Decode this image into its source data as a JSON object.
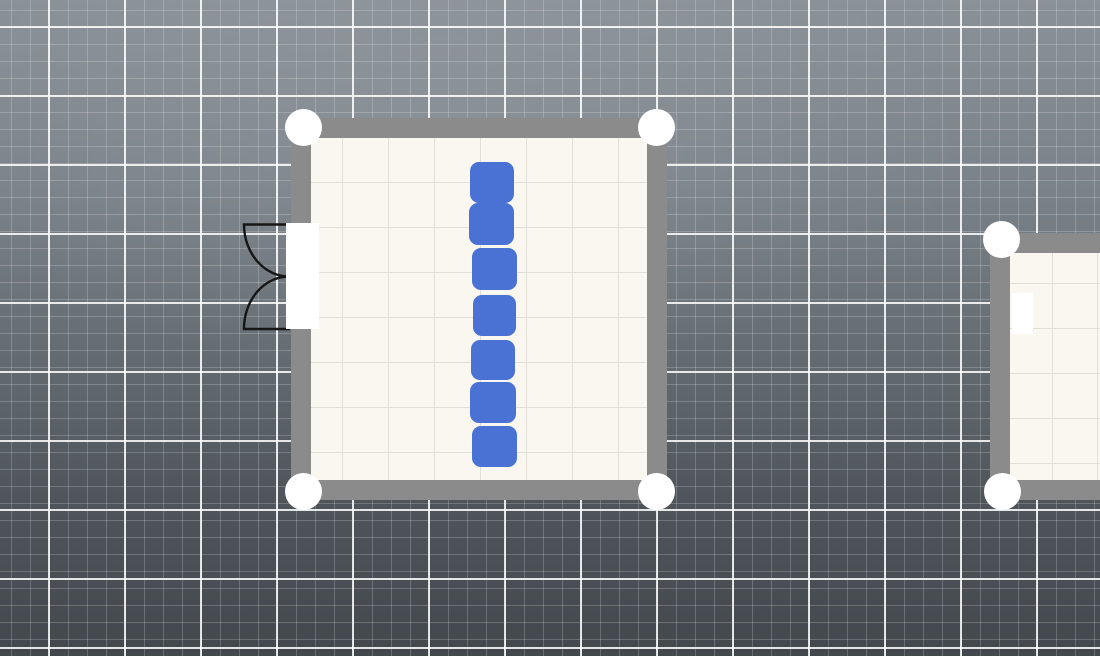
{
  "canvas": {
    "width": 1100,
    "height": 656,
    "background": {
      "top_color": "#8A9197",
      "mid_color": "#666E74",
      "bottom_color": "#43484D"
    },
    "grid": {
      "minor_spacing_x": 19,
      "minor_spacing_y": 17,
      "major_spacing_x": 76,
      "major_spacing_y": 69,
      "minor_color": "rgba(255,255,255,0.20)",
      "major_color": "rgba(255,255,255,0.85)"
    }
  },
  "handle": {
    "diameter": 37,
    "color": "#FFFFFF"
  },
  "rooms": [
    {
      "id": "main-room",
      "x": 291,
      "y": 118,
      "width": 376,
      "height": 382,
      "wall_thickness": 20,
      "wall_color": "#8B8B8B",
      "floor_color": "#FAF7F1",
      "floor_grid_color": "#E3DFD6",
      "floor_grid_size_x": 46,
      "floor_grid_size_y": 45,
      "floor_grid_offset_x": 31,
      "floor_grid_offset_y": 44,
      "handles": [
        {
          "x": 303,
          "y": 127
        },
        {
          "x": 656,
          "y": 127
        },
        {
          "x": 303,
          "y": 491
        },
        {
          "x": 656,
          "y": 491
        }
      ],
      "door_openings": [
        {
          "x": 286,
          "y": 223,
          "width": 33,
          "height": 106,
          "color": "#FFFFFF"
        }
      ],
      "door_swing": {
        "type": "double-door",
        "path": "M289 224.5 L244 224.5 A45 52 0 0 0 289 276.5 M289 329 L244 329 A45 52 0 0 1 289 276.5",
        "color": "#161616",
        "stroke_width": 2.4
      },
      "furniture": [
        {
          "x": 470,
          "y": 162,
          "width": 44,
          "height": 41,
          "color": "#4A72D4"
        },
        {
          "x": 469,
          "y": 203,
          "width": 45,
          "height": 42,
          "color": "#4A72D4"
        },
        {
          "x": 472,
          "y": 248,
          "width": 45,
          "height": 42,
          "color": "#4A72D4"
        },
        {
          "x": 473,
          "y": 295,
          "width": 43,
          "height": 41,
          "color": "#4A72D4"
        },
        {
          "x": 471,
          "y": 340,
          "width": 44,
          "height": 40,
          "color": "#4A72D4"
        },
        {
          "x": 470,
          "y": 382,
          "width": 46,
          "height": 41,
          "color": "#4A72D4"
        },
        {
          "x": 472,
          "y": 426,
          "width": 45,
          "height": 41,
          "color": "#4A72D4"
        }
      ]
    },
    {
      "id": "partial-room-right",
      "x": 990,
      "y": 233,
      "width": 200,
      "height": 267,
      "wall_thickness": 20,
      "wall_color": "#8B8B8B",
      "floor_color": "#FAF7F1",
      "floor_grid_color": "#E3DFD6",
      "floor_grid_size_x": 45,
      "floor_grid_size_y": 45,
      "floor_grid_offset_x": 42,
      "floor_grid_offset_y": 30,
      "handles": [
        {
          "x": 1001,
          "y": 239
        },
        {
          "x": 1002,
          "y": 491
        }
      ],
      "door_openings": [
        {
          "x": 1012,
          "y": 293,
          "width": 21,
          "height": 41,
          "color": "#FFFFFF"
        }
      ],
      "furniture": []
    }
  ]
}
